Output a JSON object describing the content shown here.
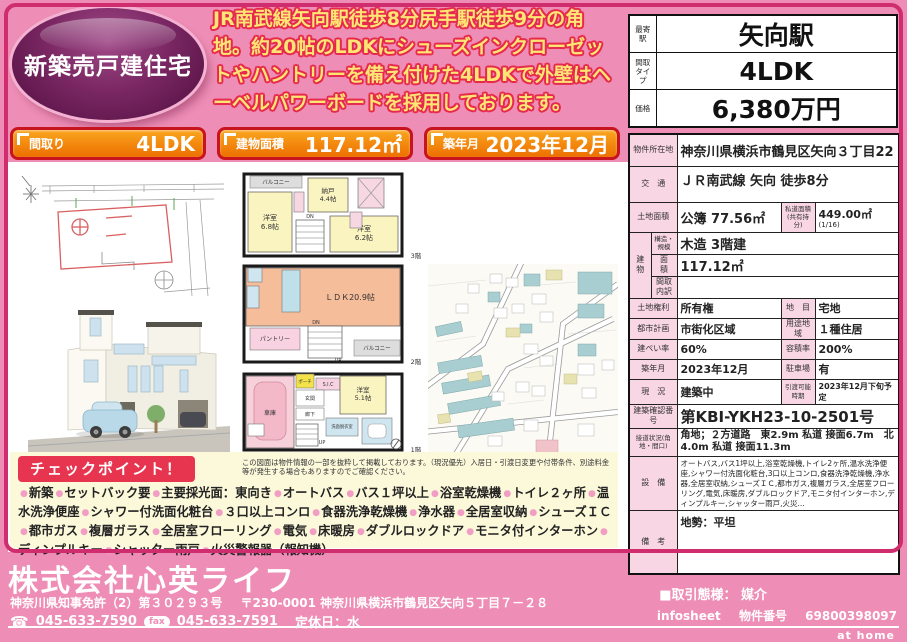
{
  "badge": {
    "label": "新築売戸建住宅"
  },
  "headline": "JR南武線矢向駅徒歩8分尻手駅徒歩9分の角地。約20帖のLDKにシューズインクローゼットやハントリーを備え付けた4LDKで外壁はヘーベルパワーボードを採用しております。",
  "station_table": {
    "rows": [
      {
        "label": "最寄駅",
        "value": "矢向駅"
      },
      {
        "label": "間取タイプ",
        "value": "4LDK"
      },
      {
        "label": "価格",
        "value": "6,380万円"
      }
    ]
  },
  "chips": [
    {
      "label": "間取り",
      "value": "4LDK"
    },
    {
      "label": "建物面積",
      "value": "117.12㎡"
    },
    {
      "label": "築年月",
      "value": "2023年12月"
    }
  ],
  "floorplan": {
    "f3": {
      "balcony": "バルコニー",
      "storage": "納戸",
      "storage_size": "4.4帖",
      "room1": "洋室",
      "room1_size": "6.8帖",
      "room2": "洋室",
      "room2_size": "6.2帖",
      "dn": "DN",
      "floor": "3階"
    },
    "f2": {
      "ldk": "ＬＤＫ20.9帖",
      "pantry": "パントリー",
      "balcony": "バルコニー",
      "up": "UP",
      "dn": "DN",
      "floor": "2階"
    },
    "f1": {
      "garage": "車庫",
      "porch": "ポーチ",
      "sic": "S.I.C",
      "entrance": "玄関",
      "hall": "廊下",
      "room": "洋室",
      "room_size": "5.1帖",
      "wash": "洗面脱衣室",
      "up": "UP",
      "floor": "1階"
    }
  },
  "note": "この図面は物件情報の一部を抜粋して掲載しております。（現況優先）入居日・引渡日変更や付帯条件、別途料金等が発生する場合もありますのでご確認ください。",
  "checkpoints": {
    "title": "チェックポイント！",
    "items": [
      "新築",
      "セットバック要",
      "主要採光面：東向き",
      "オートバス",
      "バス１坪以上",
      "浴室乾燥機",
      "トイレ２ヶ所",
      "温水洗浄便座",
      "シャワー付洗面化粧台",
      "３口以上コンロ",
      "食器洗浄乾燥機",
      "浄水器",
      "全居室収納",
      "シューズＩＣ",
      "都市ガス",
      "複層ガラス",
      "全居室フローリング",
      "電気",
      "床暖房",
      "ダブルロックドア",
      "モニタ付インターホン",
      "ディンプルキー",
      "シャッター雨戸",
      "火災警報器（報知機）"
    ]
  },
  "property_table": {
    "location_label": "物件所在地",
    "location": "神奈川県横浜市鶴見区矢向３丁目22",
    "access_label": "交　通",
    "access": "ＪＲ南武線 矢向 徒歩8分",
    "land_area_label": "土地面積",
    "land_area": "公簿 77.56㎡",
    "private_road_label": "私道面積(共有持分)",
    "private_road": "449.00㎡",
    "private_road_share": "(1/16)",
    "building_label": "建　物",
    "structure_label": "構造・規模",
    "structure": "木造 3階建",
    "bldg_area_label": "面　積",
    "bldg_area": "117.12㎡",
    "layout_detail_label": "間取内訳",
    "layout_detail": "",
    "land_right_label": "土地権利",
    "land_right": "所有権",
    "land_cat_label": "地　目",
    "land_cat": "宅地",
    "city_plan_label": "都市計画",
    "city_plan": "市街化区域",
    "zoning_label": "用途地域",
    "zoning": "１種住居",
    "coverage_label": "建ぺい率",
    "coverage": "60%",
    "far_label": "容積率",
    "far": "200%",
    "built_label": "築年月",
    "built": "2023年12月",
    "parking_label": "駐車場",
    "parking": "有",
    "status_label": "現　況",
    "status": "建築中",
    "delivery_label": "引渡可能時期",
    "delivery": "2023年12月下旬予定",
    "permit_label": "建築確認番号",
    "permit": "第KBI-YKH23-10-2501号",
    "road_label": "接道状況(角地・間口)",
    "road": "角地；２方道路　東2.9m 私道 接面6.7m　北4.0m 私道 接面11.3m",
    "equipment_label": "設　備",
    "equipment": "オートバス,バス1坪以上,浴室乾燥機,トイレ2ヶ所,温水洗浄便座,シャワー付洗面化粧台,3口以上コンロ,食器洗浄乾燥機,浄水器,全居室収納,シューズＩＣ,都市ガス,複層ガラス,全居室フローリング,電気,床暖房,ダブルロックドア,モニタ付インターホン,ディンプルキー,シャッター雨戸,火災...",
    "remarks_label": "備　考",
    "remarks": "地勢：平坦"
  },
  "footer": {
    "company": "株式会社心英ライフ",
    "license": "神奈川県知事免許（2）第３０２９３号",
    "address": "〒230-0001 神奈川県横浜市鶴見区矢向５丁目７－２８",
    "tel": "045-633-7590",
    "fax_label": "fax",
    "fax": "045-633-7591",
    "holiday": "定休日：水",
    "deal": "■取引態様：  媒介",
    "infosheet": "infosheet",
    "propno_label": "物件番号",
    "propno": "69800398097",
    "athome": "at home"
  },
  "colors": {
    "page_pink": "#ee8db5",
    "frame_crimson": "#cf2d6d",
    "chip_orange": "#ed6f00",
    "chip_border_red": "#c8141e",
    "headline_yellow": "#ffe573",
    "headline_outline_red": "#e62a4e",
    "badge_purple": "#5f1549",
    "table_label_pink": "#f9d6e4",
    "checkpoint_cream": "#fcf8da",
    "checkpoint_red": "#e8354f"
  }
}
